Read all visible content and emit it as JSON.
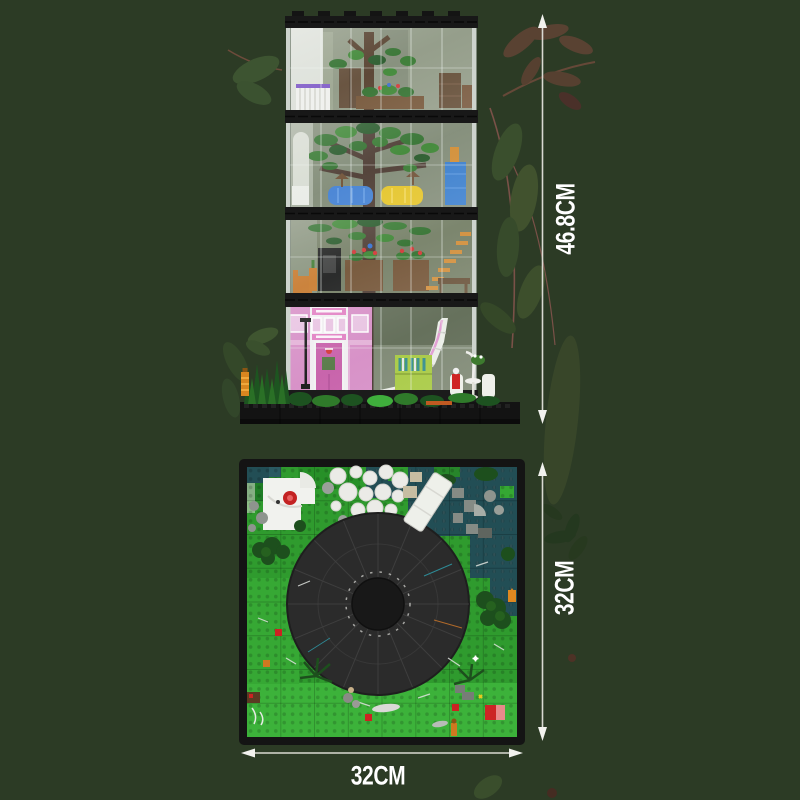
{
  "dimensions": {
    "tower_height": "46.8CM",
    "baseplate_depth": "32CM",
    "baseplate_width": "32CM"
  },
  "colors": {
    "background": "#2c3b25",
    "dimension_line": "#d9d9d2",
    "dimension_text": "#ffffff",
    "baseplate_green": "#2f9b2e",
    "water_teal": "#224e55",
    "round_roof_dark": "#2b2b2b",
    "facade_pink": "#e5b0d8",
    "foliage_green": "#2a6b26",
    "decor_leaf_green": "#3a4f2d",
    "decor_leaf_brown": "#5d4334"
  },
  "icons": {
    "arrow_up": "▲",
    "arrow_down": "▼",
    "arrow_left": "◀",
    "arrow_right": "▶"
  }
}
